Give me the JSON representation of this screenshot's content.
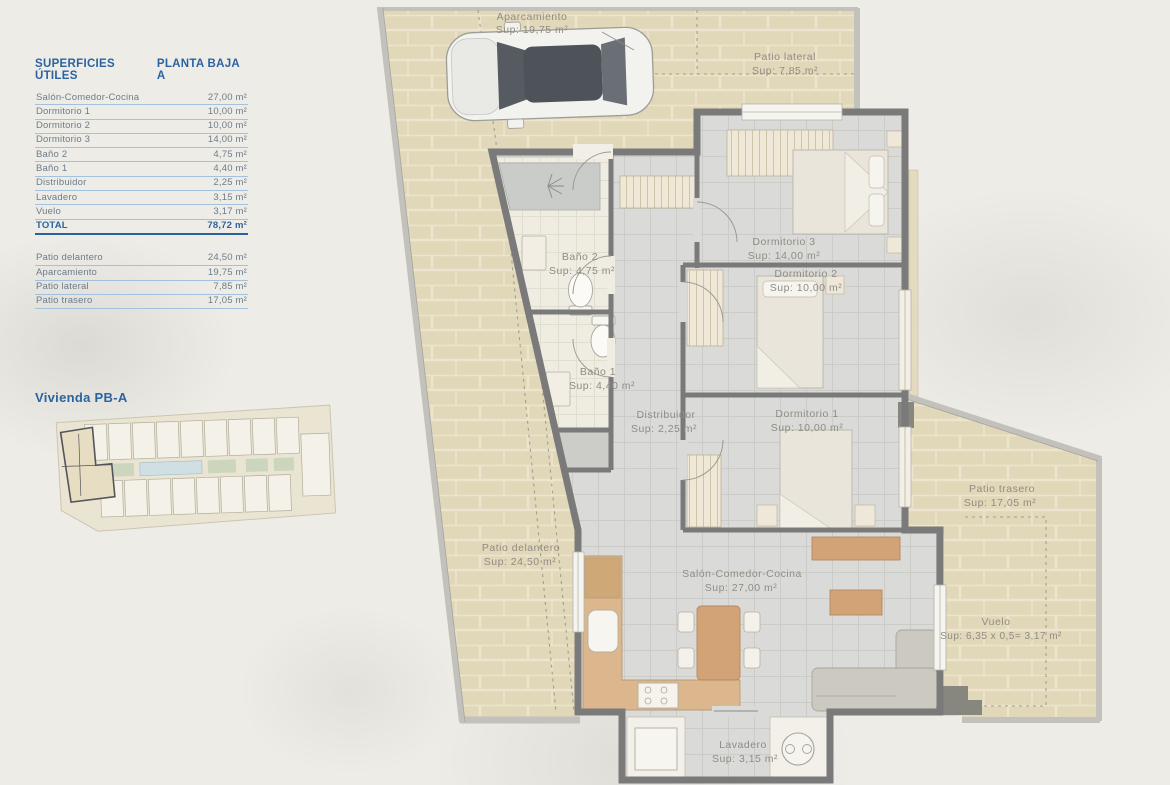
{
  "legend": {
    "title_left": "SUPERFICIES ÚTILES",
    "title_right": "PLANTA BAJA A",
    "rows": [
      {
        "label": "Salón-Comedor-Cocina",
        "value": "27,00 m²"
      },
      {
        "label": "Dormitorio 1",
        "value": "10,00 m²"
      },
      {
        "label": "Dormitorio 2",
        "value": "10,00 m²"
      },
      {
        "label": "Dormitorio 3",
        "value": "14,00 m²"
      },
      {
        "label": "Baño 2",
        "value": "4,75 m²"
      },
      {
        "label": "Baño 1",
        "value": "4,40 m²"
      },
      {
        "label": "Distribuidor",
        "value": "2,25 m²"
      },
      {
        "label": "Lavadero",
        "value": "3,15 m²"
      },
      {
        "label": "Vuelo",
        "value": "3,17 m²"
      }
    ],
    "total": {
      "label": "TOTAL",
      "value": "78,72 m²"
    },
    "exterior_rows": [
      {
        "label": "Patio delantero",
        "value": "24,50 m²"
      },
      {
        "label": "Aparcamiento",
        "value": "19,75 m²"
      },
      {
        "label": "Patio lateral",
        "value": "7,85 m²"
      },
      {
        "label": "Patio trasero",
        "value": "17,05 m²"
      }
    ]
  },
  "site_plan": {
    "title": "Vivienda PB-A"
  },
  "floor_plan": {
    "rooms": {
      "aparcamiento": {
        "name": "Aparcamiento",
        "sup": "Sup: 19,75 m²"
      },
      "patio_lateral": {
        "name": "Patio lateral",
        "sup": "Sup: 7,85 m²"
      },
      "dormitorio3": {
        "name": "Dormitorio 3",
        "sup": "Sup: 14,00 m²"
      },
      "dormitorio2": {
        "name": "Dormitorio 2",
        "sup": "Sup: 10,00 m²"
      },
      "dormitorio1": {
        "name": "Dormitorio 1",
        "sup": "Sup: 10,00 m²"
      },
      "bano2": {
        "name": "Baño 2",
        "sup": "Sup: 4,75 m²"
      },
      "bano1": {
        "name": "Baño 1",
        "sup": "Sup: 4,40 m²"
      },
      "distribuidor": {
        "name": "Distribuidor",
        "sup": "Sup: 2,25 m²"
      },
      "patio_delantero": {
        "name": "Patio delantero",
        "sup": "Sup: 24,50 m²"
      },
      "salon": {
        "name": "Salón-Comedor-Cocina",
        "sup": "Sup: 27,00 m²"
      },
      "patio_trasero": {
        "name": "Patio trasero",
        "sup": "Sup: 17,05 m²"
      },
      "vuelo": {
        "name": "Vuelo",
        "sup": "Sup: 6,35 x 0,5= 3,17 m²"
      },
      "lavadero": {
        "name": "Lavadero",
        "sup": "Sup: 3,15 m²"
      }
    }
  },
  "colors": {
    "accent_blue": "#2b63a0",
    "wall_gray": "#7a7a7a",
    "fence_gray": "#c2c1bc",
    "stone_beige": "#e1d7b9",
    "interior_floor": "#dadad8",
    "wood": "#d2a377",
    "paper": "#edece7",
    "label_gray": "#8f8c83"
  }
}
